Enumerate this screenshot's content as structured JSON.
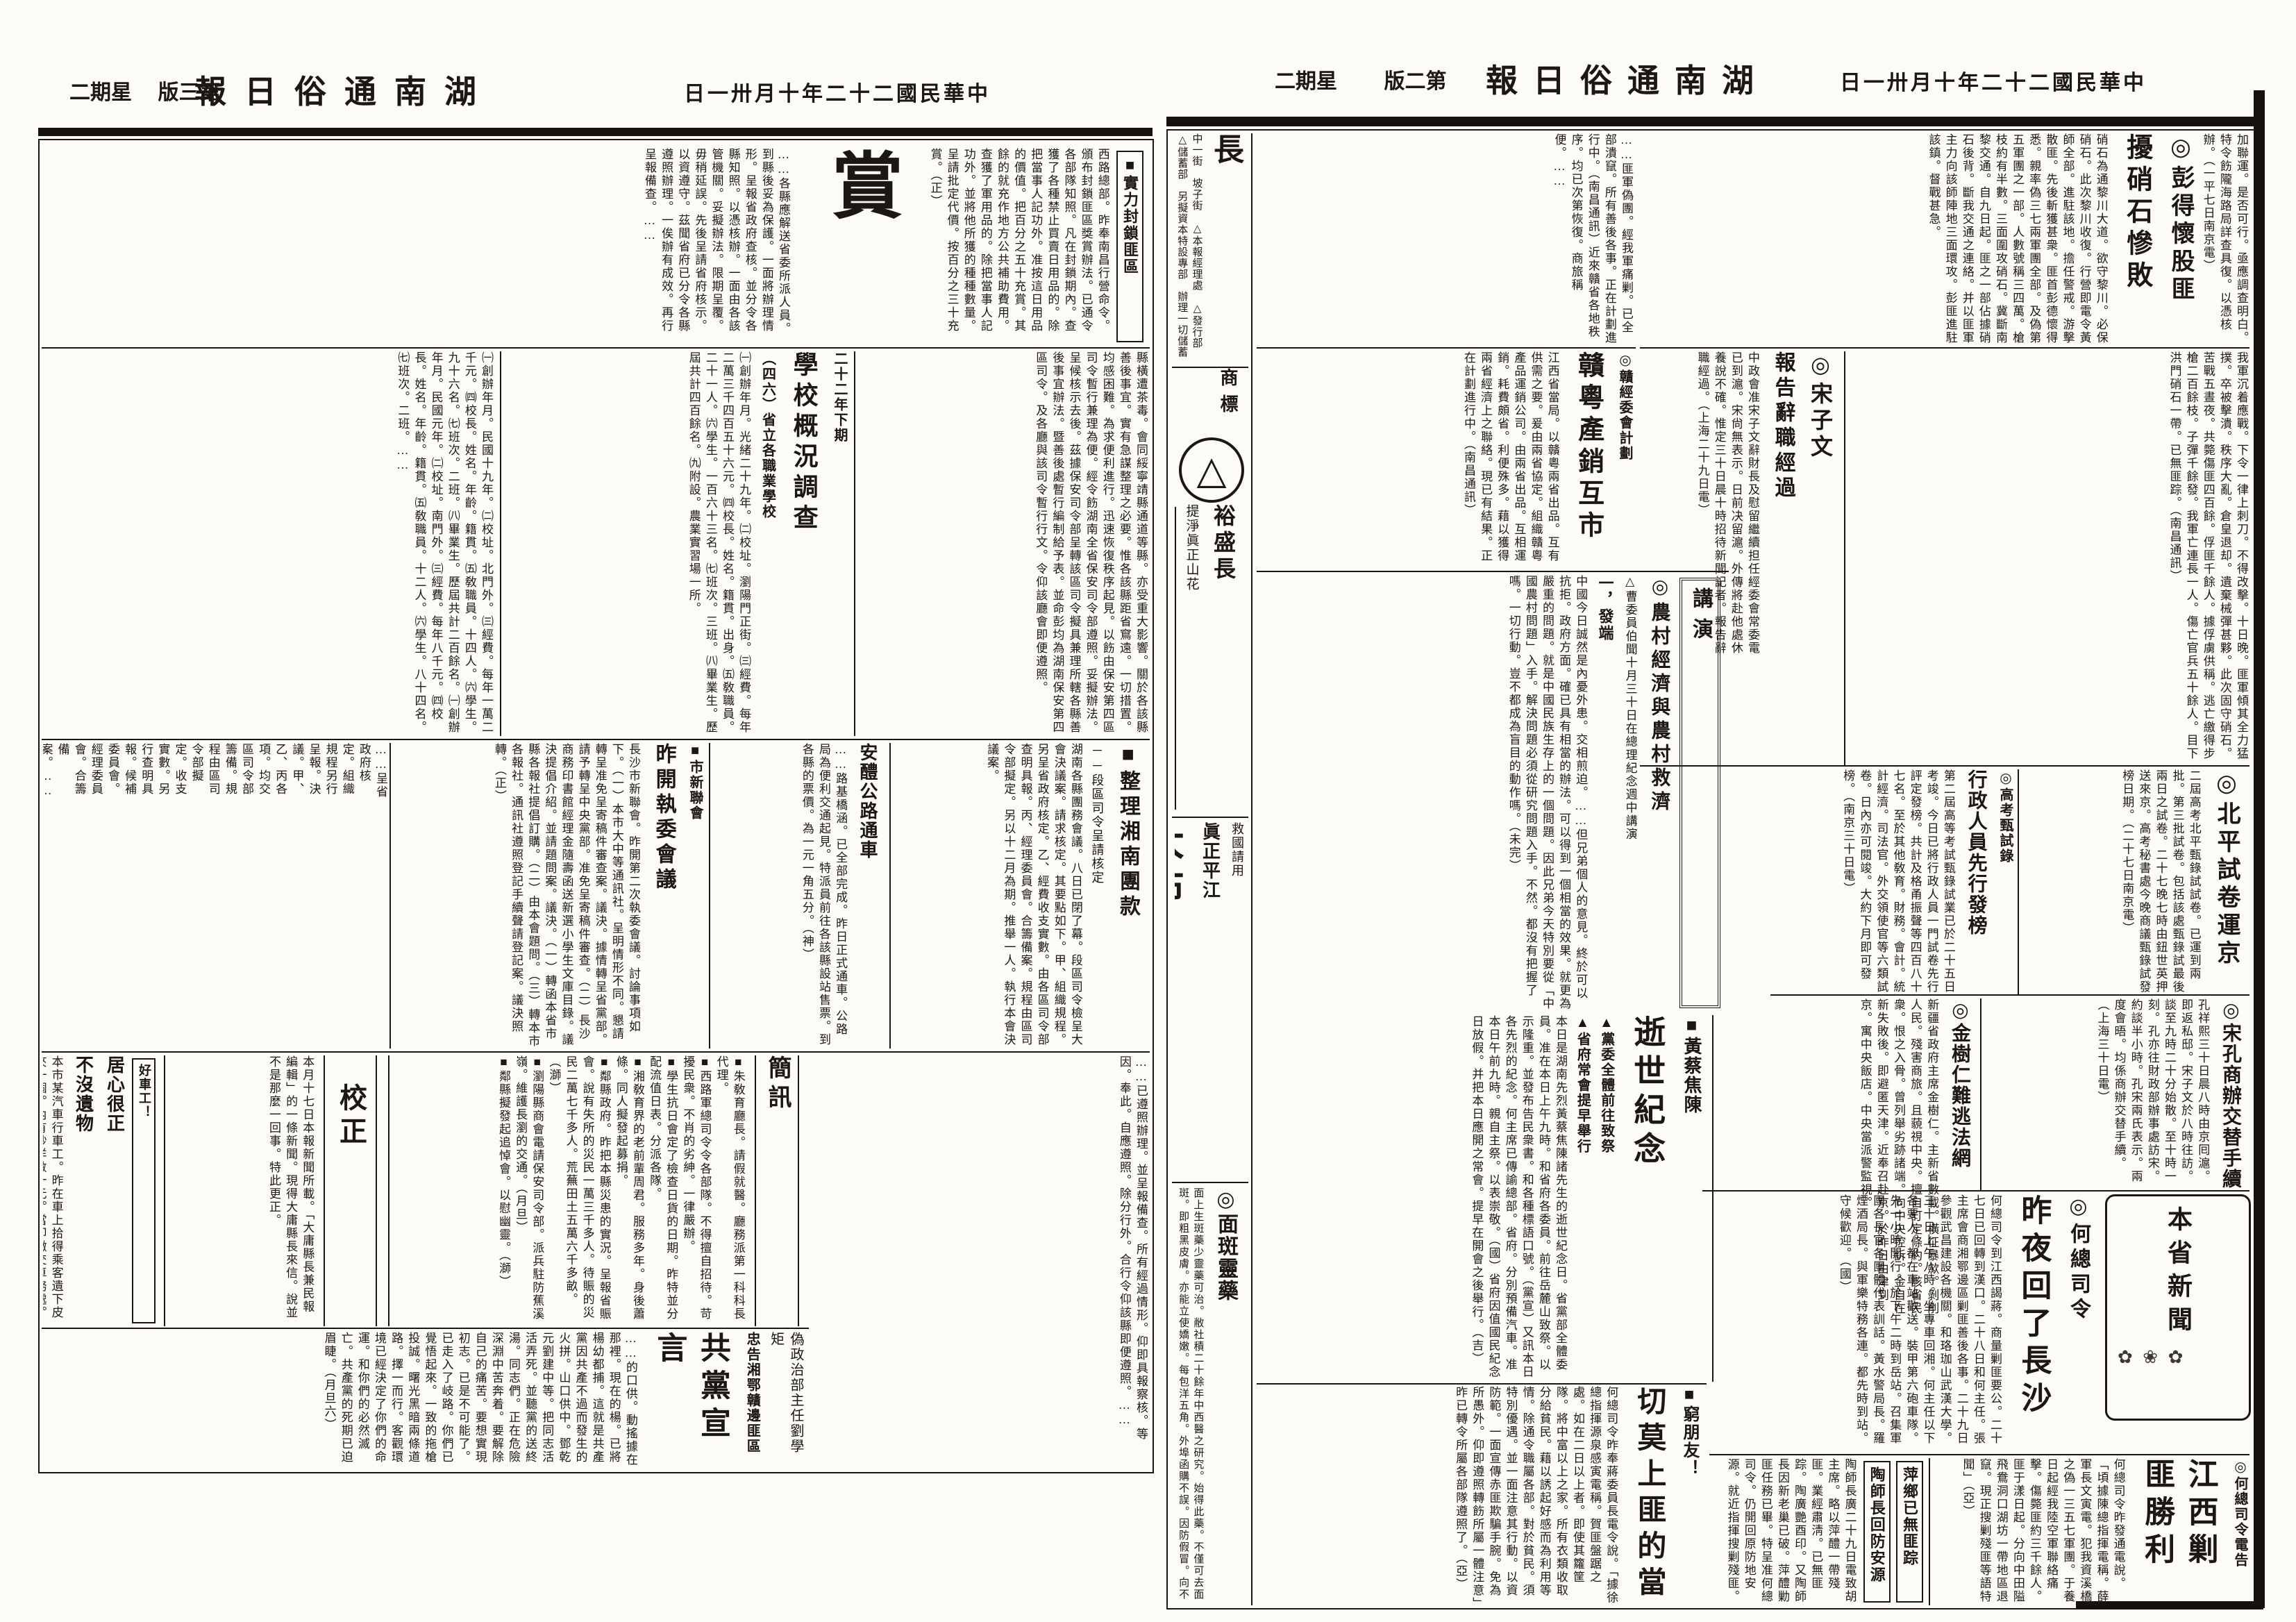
{
  "paper": {
    "background": "#fcfbf7",
    "ink": "#1b1713"
  },
  "icons": {
    "rosette": "◎",
    "square": "■",
    "triangle": "▲",
    "logo_triangle": "△",
    "flowers": "✿ ❀ ✿",
    "arrow_rule": "︱"
  },
  "masthead": {
    "title": "湖南通俗日報",
    "date": "中華民國二十二年十月卅一日",
    "weekday": "星期二",
    "page2_label": "第二版",
    "page3_label": "第三版"
  },
  "page2": {
    "colophon": {
      "city_big": "長",
      "text": "中一街　坡子街　△本報經理處　△發行部　△儲蓄部　另擬資本特設專部　辦理一切儲蓄存款　分銷處　新立街　廬惠街　中正街"
    },
    "ad_trademark": {
      "label": "商標",
      "shop": "裕盛長",
      "slogan": "提淨眞正山花",
      "product": "三角牌棉絮",
      "note": "提倡布衣救國"
    },
    "ad_dabu": {
      "slogan": "救國請用",
      "name": "眞正平江",
      "product": "大布"
    },
    "ad_lingyao": {
      "name": "面斑靈藥",
      "body": "面上生斑藥少靈藥可治。敝社積二十餘年中西醫之研究。始得此藥。不僅可去面斑。即粗黑皮膚。亦能立使嬌嫩。每包洋五角。外埠函購不誤。因防假冒。向不托人代售。"
    },
    "peng": {
      "tail": "加聯運。是否可行。亟應調查明白。特令飭隴海路局詳查具復。以憑核辦。（一平七日南京電）",
      "kicker": "彭得懷股匪",
      "headline": "擾硝石慘敗",
      "body": "硝石為通黎川大道。欲守黎川。必保硝石。此次黎川收復。行營即電令黃師全部。進駐該地。擔任警戒。游擊散匪。先後斬獲甚衆。匪首彭德懷得悉。親率偽三七兩軍團全部。及偽第五軍團之一部。人數號稱三四萬。槍枝約有半數。三面圍攻硝石。冀斷南黎交通。自九日起。匪之一部佔據硝石後背。斷我交通之連絡。并以匪軍主力向該師陣地三面環攻。彭匪進駐該鎮。督戰甚急。",
      "body2": "我軍沉着應戰。下令一律上刺刀。不得改擊。十日晚。匪軍傾其全力猛撲。卒被擊潰。秩序大亂。倉皇退却。遺棄械彈甚夥。此次固守硝石。苦戰五晝夜。共斃傷匪四百餘。俘匪千餘人。據俘虜供稱。逃亡繳得步槍二百餘枝。子彈千餘發。我軍亡連長一人。傷亡官兵五十餘人。目下洪門硝石一帶。已無匪踪。（南昌通訊）"
    },
    "song": {
      "kicker": "宋子文",
      "headline": "報告辭職經過",
      "body": "中政會准宋子文辭財長及慰留繼續担任經委會常委電已到滬。宋尙無表示。日前决留滬。外傳將赴他處休養說不確。惟定三十日晨十時招待新聞記者。報告辭職經過。（上海二十九日電）"
    },
    "misc_top": {
      "body": "……匪軍偽團。經我軍痛剿。已全部潰竄。所有善後各事。正在計劃進行中。（南昌通訊）近來贛省各地秩序。均已次第恢復。商旅稱便。……"
    },
    "gan": {
      "kicker": "贛經委會計劃",
      "headline": "贛粵產銷互市",
      "body": "江西省當局。以贛粵兩省出品。互有供需之要。爰由兩省協定。組織贛粵產品運銷公司。由兩省出品。互相運銷。耗費頗省。利便殊多。藉以獲得兩省經濟上之聯絡。現已有結果。正在計劃進行中。（南昌通訊）"
    },
    "nongcun": {
      "banner": "講演",
      "headline": "農村經濟與農村救濟",
      "kicker": "△曹委員伯聞十月三十日在總理紀念週中講演",
      "sub": "一，發端",
      "body": "中國今日誠然是內憂外患。交相煎迫。……但兄弟個人的意見。終於可以抗拒。政府方面。確已具有相當的辦法。可以得到一個相當的效果。就更為嚴重的問題。就是中國民族生存上的一個問題。因此兄弟今天特別要從「中國農村問題」入手。解決問題必須從研究問題入手。不然。都沒有把握了嗎。一切行動。豈不都成為盲目的動作嗎。（未完）"
    },
    "beiping": {
      "headline": "北平試卷運京",
      "body": "二屆高考北平甄錄試試卷。已運到兩批。第三批試卷。包括該處甄錄試最後兩日之試卷。二十七晚七時由鈕世英押送來京。高考秘書處今晚商議甄錄試發榜日期。（二十七日南京電）"
    },
    "gaokao": {
      "kicker": "高考甄試錄",
      "headline": "行政人員先行發榜",
      "body": "第二屆高等考試甄錄試業已於二十五日考竣。今日已將行政人員一門試卷先行評定發榜。共計及格甬振聲等四百八十七名。至於其他敎育。財務。會計。統計經濟。司法官。外交領使官等六類試卷。日內亦可閱竣。大約下月即可發榜。（南京三十日電）"
    },
    "songkong": {
      "headline": "宋孔商辦交替手續",
      "body": "孔祥熙三十日晨八時由京囘滬。即返私邸。宋子文於八時往訪。談至九時二十分始散。至十時一刻。孔亦往財政部辦事處訪宋。約談半小時。孔宋兩氏表示。兩度會晤。均係商辦交替手續。（上海三十日電）"
    },
    "jin": {
      "headline": "金樹仁難逃法網",
      "body": "新疆省政府主席金樹仁。主新省數載。橫征暴歛。剝削人民。殘害商旅。且藐視中央。擅自訂定條約。該省民衆。恨之入骨。曾列舉劣跡諸端。向中央控訴。金自在新失敗後。即避匿天津。近奉召赴京。於昨日由津到京。寓中央飯店。中央當派警監視。"
    },
    "shishi": {
      "kicker": "黃蔡焦陳",
      "headline": "逝世紀念",
      "sub1": "▲黨委全體前往致祭",
      "sub2": "▲省府常會提早舉行",
      "body": "本日是湖南先烈黃蔡焦陳諸先生的逝世紀念日。省黨部全體委員。准在本日上午九時。和省府各委員。前往岳麓山致祭。以示隆重。並發布告民衆書。和各種標語口號。（黨宣）又訊本日各先烈的紀念。何主席已傳諭總部。省府。分別預備汽車。准本日午前九時。親自主祭。以表崇敬。（國）省府因值國民紀念日放假。并把本日應開之常會。提早在開會之後舉行。（吉）"
    },
    "he": {
      "kicker": "何總司令",
      "headline": "昨夜回了長沙",
      "body": "何總司令到江西謁蔣。商量剿匪要公。二十七日已回轉到漢口。二十八日和何主任。張主席會商湘鄂邊區剿匪善後各事。二十九日參觀武昌建設各機關。和珞珈山武漢大學。三十日上午八時。坐專車回湘。何主任以下各要人。都在車站歡送。裝甲第六砲車隊。先一小時開行。於下午二時到岳站。召集軍團各長官各團體代表訓話。黃水警局長。羅煙酒局長。與軍樂特務各連。都先時到站。守候歡迎。（國）"
    },
    "benxing_label": "本省新聞",
    "jiangxi": {
      "kicker": "何總司令電告",
      "headline": "江西剿匪勝利",
      "body": "何總司令昨發通電說。「頃據陳總指揮電稱。薛軍長文寅電。犯我資溪橋之偽一三五七軍團。于養日起經我陸空軍聯絡痛擊。傷斃匪約三千餘人。匪于漾日起。分向中田隘飛鴦洞口湖坊一帶地區退竄。現正搜剿殘匪等語特聞」（亞）"
    },
    "pingxiang": {
      "box1": "萍鄉已無匪踪",
      "box2": "陶師長回防安源",
      "body": "陶師長廣二十九日電致胡主席。略以萍醴一帶殘匪。業經肅淸。已無匪踪。陶廣艷酉印。又陶師長因新老巢已破。萍醴勦匪任務已畢。特呈准何總司令。仍開回原防地安源。就近指揮搜剿殘匪。"
    },
    "qiong": {
      "kicker": "窮朋友！",
      "headline": "切莫上匪的當",
      "body": "何總司令昨奉蔣委員長電令說。「據徐總指揮源泉感寅電稱。賀匪盤踞之處。如在二日以上者。即使其籮筐隊。將中富以上之家。所有衣類收取分給貧民。藉以誘起好感而為利用等情。除通令職屬各部。對於貧民。須特別優遇。並一面注意其行動。以資防範。一面宣傳赤匪欺騙手腕。免為所愚外。仰即遵照轉飭所屬一體注意」昨已轉令所屬各部隊遵照了。（亞）"
    }
  },
  "page3": {
    "shang": {
      "label": "實力封鎖匪區",
      "bigchar": "賞",
      "body": "西路總部。昨奉南昌行營命令。頒布封鎖匪區獎賞辦法。已通令各部隊知照。凡在封鎖期內。查獲了各種禁止買賣日用品的。除把當事人記功外。准按這日用品的價值。把百分之五十充賞。其餘的就充作地方公共補助費用。查獲了軍用品的。除把當事人記功外。並將他所獲的種種數量。呈請批定代價。按百分之三十充賞。（正）"
    },
    "topfill": {
      "body": "……各縣應解送省委所派人員。到縣後妥為保護。一面將辦理情形。呈報省政府查核。並分令各縣知照。以憑核辦。一面由各該管機關。妥擬辦法。限期呈覆。毋稍延誤。先後呈請省府核示。以資遵守。茲聞省府已分令各縣遵照辦理。一俟辦有成效。再行呈報備查。……"
    },
    "feiqu": {
      "body": "縣橫遭茶毒。會同綏寧靖縣通道等縣。亦受重大影響。關於各該縣善後事宜。實有急謀整理之必要。惟各該縣距省窵遠。一切措置。均感困難。為求便利進行。迅速恢復秩序起見。以飭由保安第四區司令暫行兼理為便。經令飭湖南全省保安司令部遵照。妥擬辦法。呈候核示去後。茲據保安司令部呈轉該區司令擬具兼理所轄各縣善後事宜辦法。暨善後處暫行編制給予表。並命彭均為湖南保安第四區司令。及各廳與該司令暫行行文。令仰該廳會即便遵照。"
    },
    "school": {
      "kicker": "二十二年下期",
      "headline": "學校概況調查",
      "sub": "（四六）省立各職業學校",
      "body": "㈠創辦年月。光緒二十九年。㈡校址。瀏陽門正街。㈢經費。每年二萬三千四百五十六元。㈣校長。姓名。籍貫。出身。㈤敎職員。二十一人。㈥學生。一百六十三名。㈦班次。三班。㈧畢業生。歷屆共計四百餘名。㈨附設。農業實習場一所。"
    },
    "bfill": {
      "body": "㈠創辦年月。民國十九年。㈡校址。北門外。㈢經費。每年一萬二千元。㈣校長。姓名。年齡。籍貫。㈤敎職員。十四人。㈥學生。九十六名。㈦班次。二班。㈧畢業生。歷屆共計二百餘名。㈠創辦年月。民國元年。㈡校址。南門外。㈢經費。每年八千元。㈣校長。姓名。年齡。籍貫。㈤敎職員。十二人。㈥學生。八十四名。㈦班次。二班。……"
    },
    "tuankuan": {
      "headline": "整理湘南團款",
      "sub": "──段區司令呈請核定",
      "body": "湖南各縣團務會議。八日已閉了幕。段區司令檢呈大會決議案。請求核定。其要點如下。甲、組織規程。另呈省政府核定。乙、經費收支實數。由各區司令部查明具報。丙、經理委員會。合籌備案。規程由區司令部擬定。另以十二月為期。推舉一人。執行本會決議案。"
    },
    "gonglu": {
      "headline": "安醴公路通車",
      "body": "……路基橋涵。已全部完成。昨日正式通車。公路局為便利交通起見。特派員前往各該縣設站售票。到各縣的票價。為一元一角五分。（神）"
    },
    "xinlian": {
      "kicker": "市新聯會",
      "headline": "昨開執委會議",
      "body": "長沙市新聯會。昨開第二次執委會議。討論事項如下。（一）本市大中等通訊社。呈明情形不同。懇請轉呈准免呈寄稿件審查案。議決。據情轉呈省黨部。請予轉呈中央黨部。准免呈寄稿件審查。（二）長沙商務印書館經理金隨壽函送新選小學生文庫目錄。議決提倡介紹。並請題問案。議決。（一）轉函本省市縣各報社提倡訂購。（二）由本會題問。（三）轉本市各報社。通訊社遵照登記手續聲請登記案。議決照轉。（正）"
    },
    "jianxun": {
      "headline": "簡訊",
      "items": [
        "■朱敎育廳長。請假就醫。廳務派第一科科長代理。",
        "■西路軍總司令令各部隊。不得擅自招待。苛擾民衆。不肖的劣紳。一律嚴辦。",
        "■學生抗日會定了檢查日貨的日期。昨特並分配流值日表。分派各隊。",
        "■湘敎育界的老前輩周君。服務多年。身後蕭條。同人擬發起募捐。",
        "■鄰縣政府。昨把本縣災患的實況。呈報省賑會。說有失所的災民一萬三千多人。待賑的災民二萬七千多人。荒蕪田土五萬六千多畝。（溮）",
        "■瀏陽縣商會電請保安司令部。派兵駐防蕉溪嶺。維護長瀏的交通。（月旦）",
        "■鄰縣擬發起追悼會。以慰幽靈。（溮）"
      ]
    },
    "jiaozheng": {
      "headline": "校正",
      "body": "本月十七日本報新聞所載。「大庸縣長兼民報編輯」的一條新聞。現得大庸縣長來信。說並不是那麼一回事。特此更正。"
    },
    "juxin": {
      "kicker": "好車工！",
      "h1": "居心很正",
      "h2": "不沒遺物",
      "body": "本市某汽車行車工。昨在車上拾得乘客遺下皮夾一個。內有鈔洋數十元。當即繳交車務處。原物歸還失主。居心之正。殊堪嘉許。"
    },
    "gongdang": {
      "kicker1": "偽政治部主任劉學矩",
      "kicker2": "忠告湘鄂贛邊匪區",
      "headline": "共黨宣言",
      "body": "……的口供。動搖據在那裡。現在的楊。已將楊幼都捕。這就是共產黨因共產不過而發生的火拼。山口供中。鄧乾元劉建中等。把同志活活弄死。並聽黨的送終湯。同志們。正在危險深淵中苦奔着。要解除自己的痛苦。要想實現初志。已是不可能了。已走入了岐路。你們已覺悟起來。一致的拖槍投誠。曙光黑暗兩條道路。擇一而行。客觀環境已經決定了你們的命運。和你們的必然滅亡。共產黨的死期已迫眉睫。（月旦六）"
    },
    "rfill": {
      "body": "……已遵照辦理。並呈報備查。所有經過情形。仰即具報察核。等因。奉此。自應遵照。除分行外。合行令仰該縣即便遵照。……"
    },
    "cfill": {
      "body": "……呈省政府核定。組織規程另行呈報。決議。甲、乙、丙各項。均交區司令部籌備。規程由區司令部擬定。收支實數。另行查明具報。候補委員會。經理委員會。合籌備案。……"
    }
  }
}
